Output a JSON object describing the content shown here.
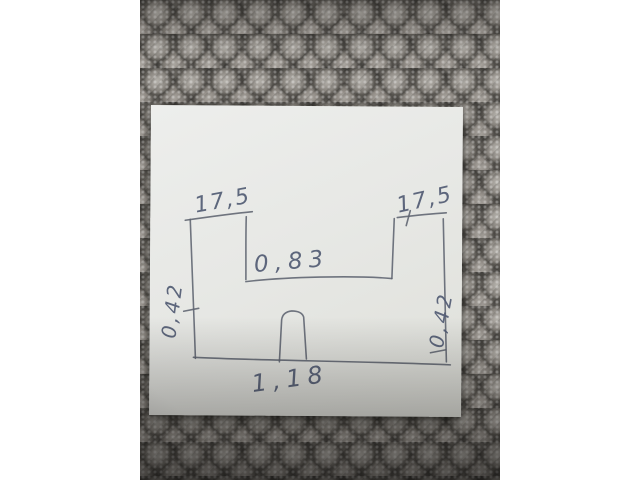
{
  "scene": {
    "frame_background": "#ffffff",
    "carpet": {
      "base_color": "#79756f",
      "highlight_color": "#b4b1ab",
      "shadow_color": "#34322f"
    },
    "paper": {
      "color": "#e8e9e5",
      "ink_color": "#5d6370"
    }
  },
  "sketch": {
    "shape": "u-channel-profile-with-arch-notch",
    "labels": {
      "top_left_width": "17,5",
      "top_right_width": "17,5",
      "inner_width": "0,83",
      "left_height": "0,42",
      "right_height": "0,42",
      "bottom_width": "1,18"
    }
  }
}
